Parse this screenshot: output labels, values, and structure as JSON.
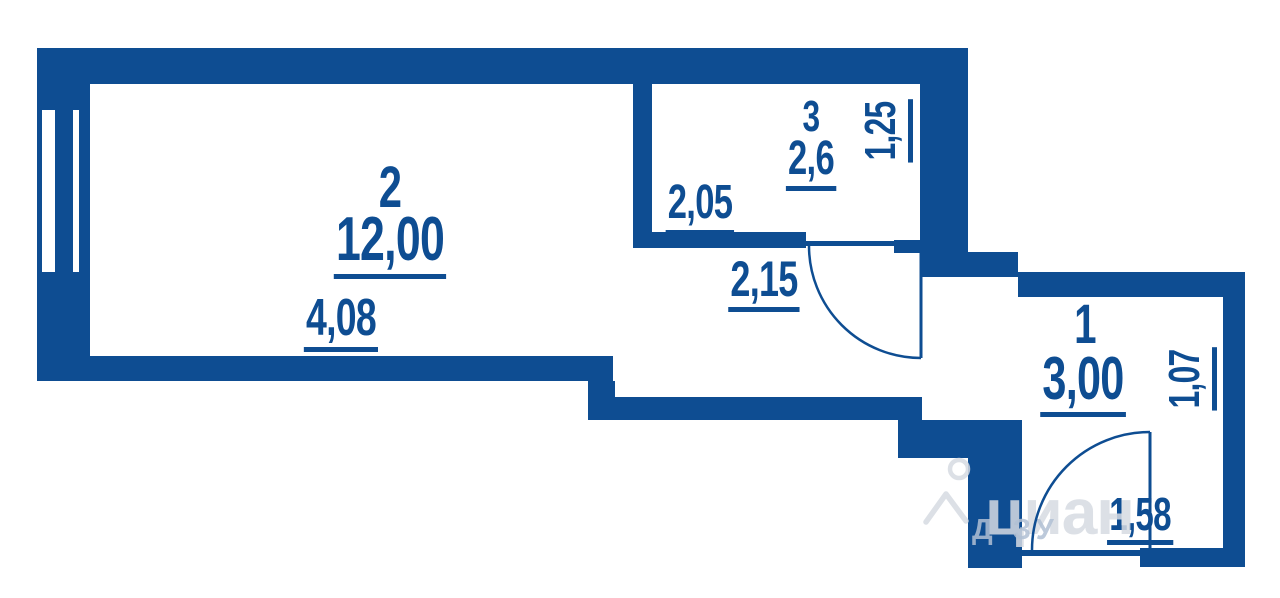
{
  "plan": {
    "rooms": [
      {
        "name": "room-2",
        "number": "2",
        "area": "12,00",
        "width_dim": "4,08"
      },
      {
        "name": "room-3",
        "number": "3",
        "area": "2,6",
        "width_dim": "2,05",
        "depth_dim": "1,25"
      },
      {
        "name": "room-1",
        "number": "1",
        "area": "3,00",
        "depth_dim": "1,07",
        "door_dim": "1,58"
      }
    ],
    "hall_door_dim": "2,15"
  },
  "watermark": {
    "logo_text": "циан",
    "sub_text": "Д ЗУ",
    "icon": "cian-pin-icon"
  },
  "colors": {
    "wall_blue": "#0e4d92",
    "label_blue": "#0e4d92",
    "watermark_light": "rgba(214,219,226,0.85)",
    "watermark_blue": "rgba(176,192,212,0.85)",
    "background": "#ffffff"
  }
}
